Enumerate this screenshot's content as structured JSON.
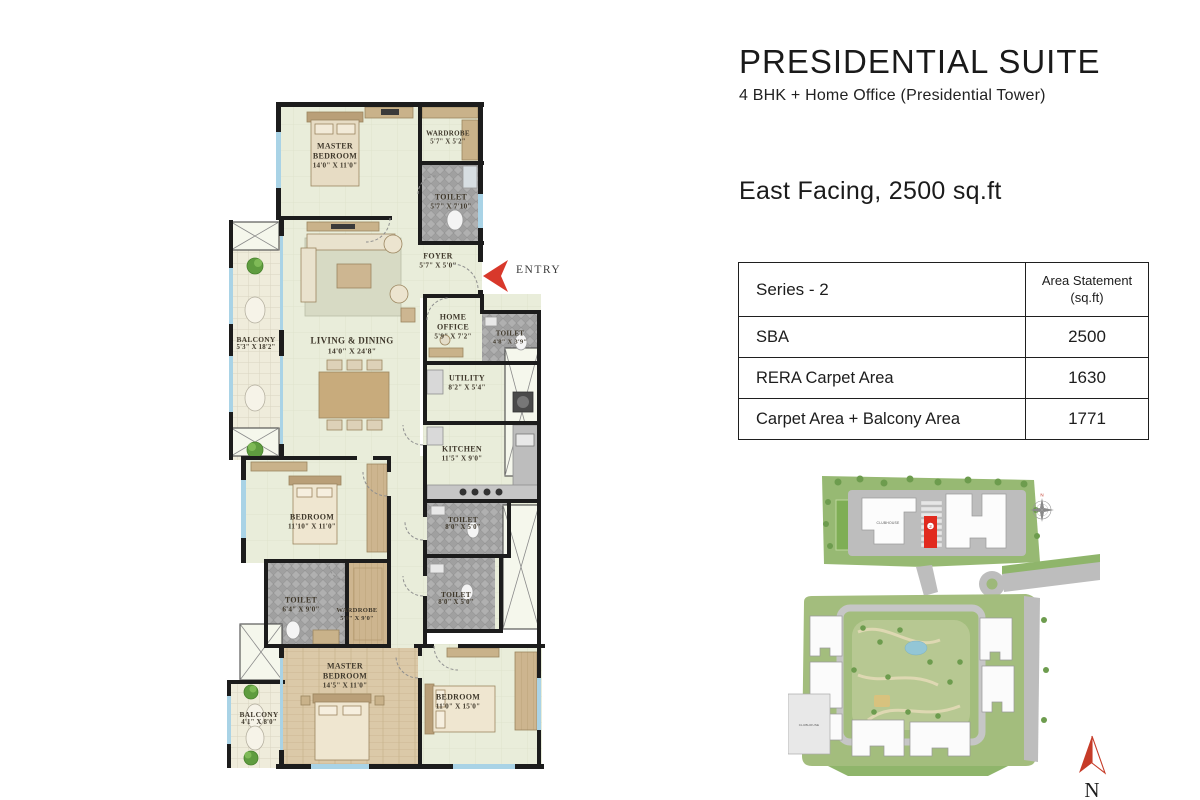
{
  "page": {
    "title": "PRESIDENTIAL SUITE",
    "subtitle": "4 BHK + Home Office (Presidential Tower)",
    "facing_line": "East Facing, 2500 sq.ft"
  },
  "area_table": {
    "header_left": "Series - 2",
    "header_right_line1": "Area Statement",
    "header_right_line2": "(sq.ft)",
    "rows": [
      {
        "label": "SBA",
        "value": "2500"
      },
      {
        "label": "RERA Carpet Area",
        "value": "1630"
      },
      {
        "label": "Carpet Area + Balcony Area",
        "value": "1771"
      }
    ]
  },
  "floor_plan": {
    "entry_label": "ENTRY",
    "rooms": {
      "master_bedroom_top": {
        "line1": "MASTER",
        "line2": "BEDROOM",
        "dim": "14'0\" X 11'0\""
      },
      "wardrobe_top": {
        "line1": "WARDROBE",
        "dim": "5'7\" X 5'2\""
      },
      "toilet_top": {
        "line1": "TOILET",
        "dim": "5'7\" X 7'10\""
      },
      "foyer": {
        "line1": "FOYER",
        "dim": "5'7\" X 5'0\""
      },
      "balcony_left": {
        "line1": "BALCONY",
        "dim": "5'3\" X 18'2\""
      },
      "living_dining": {
        "line1": "LIVING & DINING",
        "dim": "14'0\" X 24'8\""
      },
      "home_office": {
        "line1": "HOME",
        "line2": "OFFICE",
        "dim": "5'9\" X 7'2\""
      },
      "toilet_office": {
        "line1": "TOILET",
        "dim": "4'8\" X 3'9\""
      },
      "utility": {
        "line1": "UTILITY",
        "dim": "8'2\" X 5'4\""
      },
      "kitchen": {
        "line1": "KITCHEN",
        "dim": "11'5\" X 9'0\""
      },
      "toilet_kitchen": {
        "line1": "TOILET",
        "dim": "8'0\" X 5'0\""
      },
      "toilet_mid": {
        "line1": "TOILET",
        "dim": "8'0\" X 5'0\""
      },
      "bedroom_mid": {
        "line1": "BEDROOM",
        "dim": "11'10\" X 11'0\""
      },
      "toilet_lower": {
        "line1": "TOILET",
        "dim": "6'4\" X 9'0\""
      },
      "wardrobe_lower": {
        "line1": "WARDROBE",
        "dim": "5'0\" X 9'0\""
      },
      "master_bedroom_bottom": {
        "line1": "MASTER",
        "line2": "BEDROOM",
        "dim": "14'5\" X 11'0\""
      },
      "bedroom_bottom": {
        "line1": "BEDROOM",
        "dim": "11'0\" X 15'0\""
      },
      "balcony_bottom": {
        "line1": "BALCONY",
        "dim": "4'1\" X 8'0\""
      }
    }
  },
  "site_plan": {
    "clubhouse_top": "CLUBHOUSE",
    "clubhouse_bottom": "CLUBHOUSE",
    "unit_marker": "2",
    "compass_letter": "N",
    "north_letter": "N"
  },
  "colors": {
    "wall": "#1c1c1c",
    "floor": "#e9edda",
    "toilet_floor": "#ababab",
    "wood": "#cdb58f",
    "entry_arrow": "#d8382b",
    "north_arrow": "#c63b28",
    "site_green": "#97b973"
  }
}
